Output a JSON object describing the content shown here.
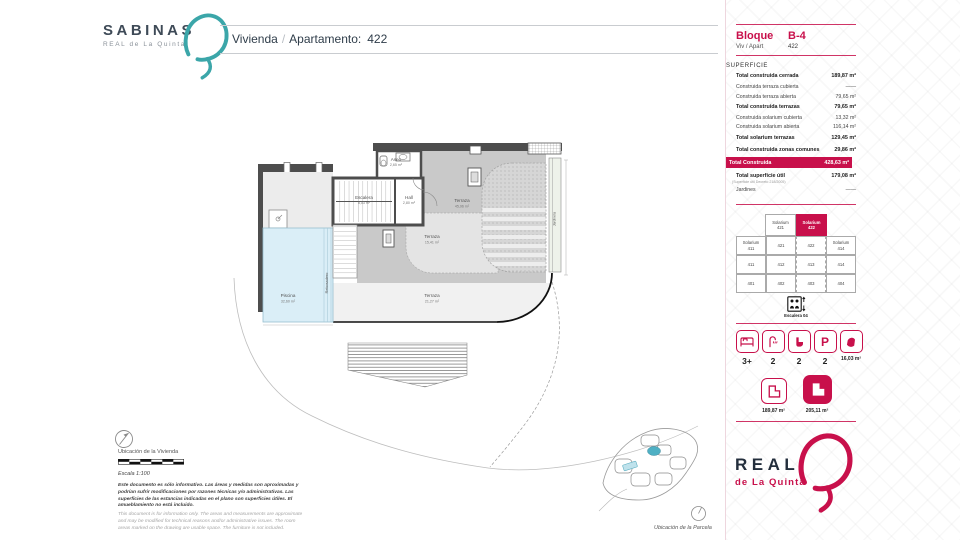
{
  "colors": {
    "accent": "#C8104B",
    "teal": "#3BA6A9",
    "navy": "#232E3C"
  },
  "header": {
    "brand": "SABINAS",
    "brand_sub": "REAL de La Quinta",
    "title_left": "Vivienda",
    "title_sep": "/",
    "title_right": "Apartamento:",
    "title_number": "422"
  },
  "plan": {
    "aseo_name": "Aseo",
    "aseo_area": "2,65 m²",
    "escalera_name": "Escalera",
    "escalera_area": "8,03 m²",
    "hall_name": "Hall",
    "hall_area": "2,80 m²",
    "terraza1_name": "Terraza",
    "terraza1_area": "45,96 m²",
    "terraza2_name": "Terraza",
    "terraza2_area": "15,41 m²",
    "terraza3_name": "Terraza",
    "terraza3_area": "21,27 m²",
    "piscina_name": "Piscina",
    "piscina_area": "32,60 m²",
    "rebosadero": "Rebosadero",
    "jardinera": "Jardinera"
  },
  "sidebar": {
    "bloque_label": "Bloque",
    "bloque_value": "B-4",
    "viv_label": "Viv / Apart",
    "viv_value": "422",
    "superficie_title": "SUPERFICIE",
    "surface_rows": [
      {
        "label": "Total construida cerrada",
        "value": "189,87 m²"
      },
      {
        "label": "Construida terraza cubierta",
        "value": "——"
      },
      {
        "label": "Construida terraza abierta",
        "value": "79,65 m²"
      },
      {
        "label": "Total construida terrazas",
        "value": "79,65 m²"
      },
      {
        "label": "Construida solarium cubierta",
        "value": "13,32 m²"
      },
      {
        "label": "Construida solarium abierta",
        "value": "116,14 m²"
      },
      {
        "label": "Total solarium terrazas",
        "value": "129,45 m²"
      },
      {
        "label": "Total construida zonas comunes",
        "value": "29,86 m²"
      }
    ],
    "total_label": "Total Construida",
    "total_value": "428,63 m²",
    "util_label": "Total superficie útil",
    "util_note": "(Superficie útil Decreto 218/2005)",
    "util_value": "179,08 m²",
    "jardines_label": "Jardines",
    "jardines_value": "——",
    "grid": {
      "top": [
        {
          "l1": "Solarium",
          "l2": "421"
        },
        {
          "l1": "Solarium",
          "l2": "422"
        }
      ],
      "r1": [
        {
          "l1": "Solarium",
          "l2": "411"
        },
        {
          "l2": "421"
        },
        {
          "l2": "422"
        },
        {
          "l1": "Solarium",
          "l2": "414"
        }
      ],
      "r2": [
        "411",
        "412",
        "413",
        "414"
      ],
      "r3": [
        "401",
        "402",
        "403",
        "404"
      ],
      "stairs_label": "Escalera 04"
    },
    "features": [
      {
        "name": "bedrooms",
        "value": "3+"
      },
      {
        "name": "showers",
        "value": "2"
      },
      {
        "name": "toilets",
        "value": "2"
      },
      {
        "name": "parking",
        "value": "2",
        "glyph": "P"
      },
      {
        "name": "storage",
        "value": "16,03 m²"
      }
    ],
    "area_badges": [
      {
        "value": "189,87 m²"
      },
      {
        "value": "205,11 m²"
      }
    ],
    "logo_line1": "REAL",
    "logo_line2": "de La Quinta"
  },
  "footer": {
    "ubicacion_vivienda": "Ubicación de la Vivienda",
    "escala": "Escala 1:100",
    "disclaimer_es": "Este documento es sólo informativo. Las áreas y medidas son aproximadas y podrían sufrir modificaciones por razones técnicas y/o administrativas. Las superficies de las estancias indicadas en el plano son superficies útiles. El amueblamiento no está incluido.",
    "disclaimer_en": "This document is for information only. The areas and measurements are approximate and may be modified for technical reasons and/or administrative issues. The room areas marked on the drawing are usable space. The furniture is not included.",
    "ubicacion_parcela": "Ubicación de la Parcela"
  }
}
